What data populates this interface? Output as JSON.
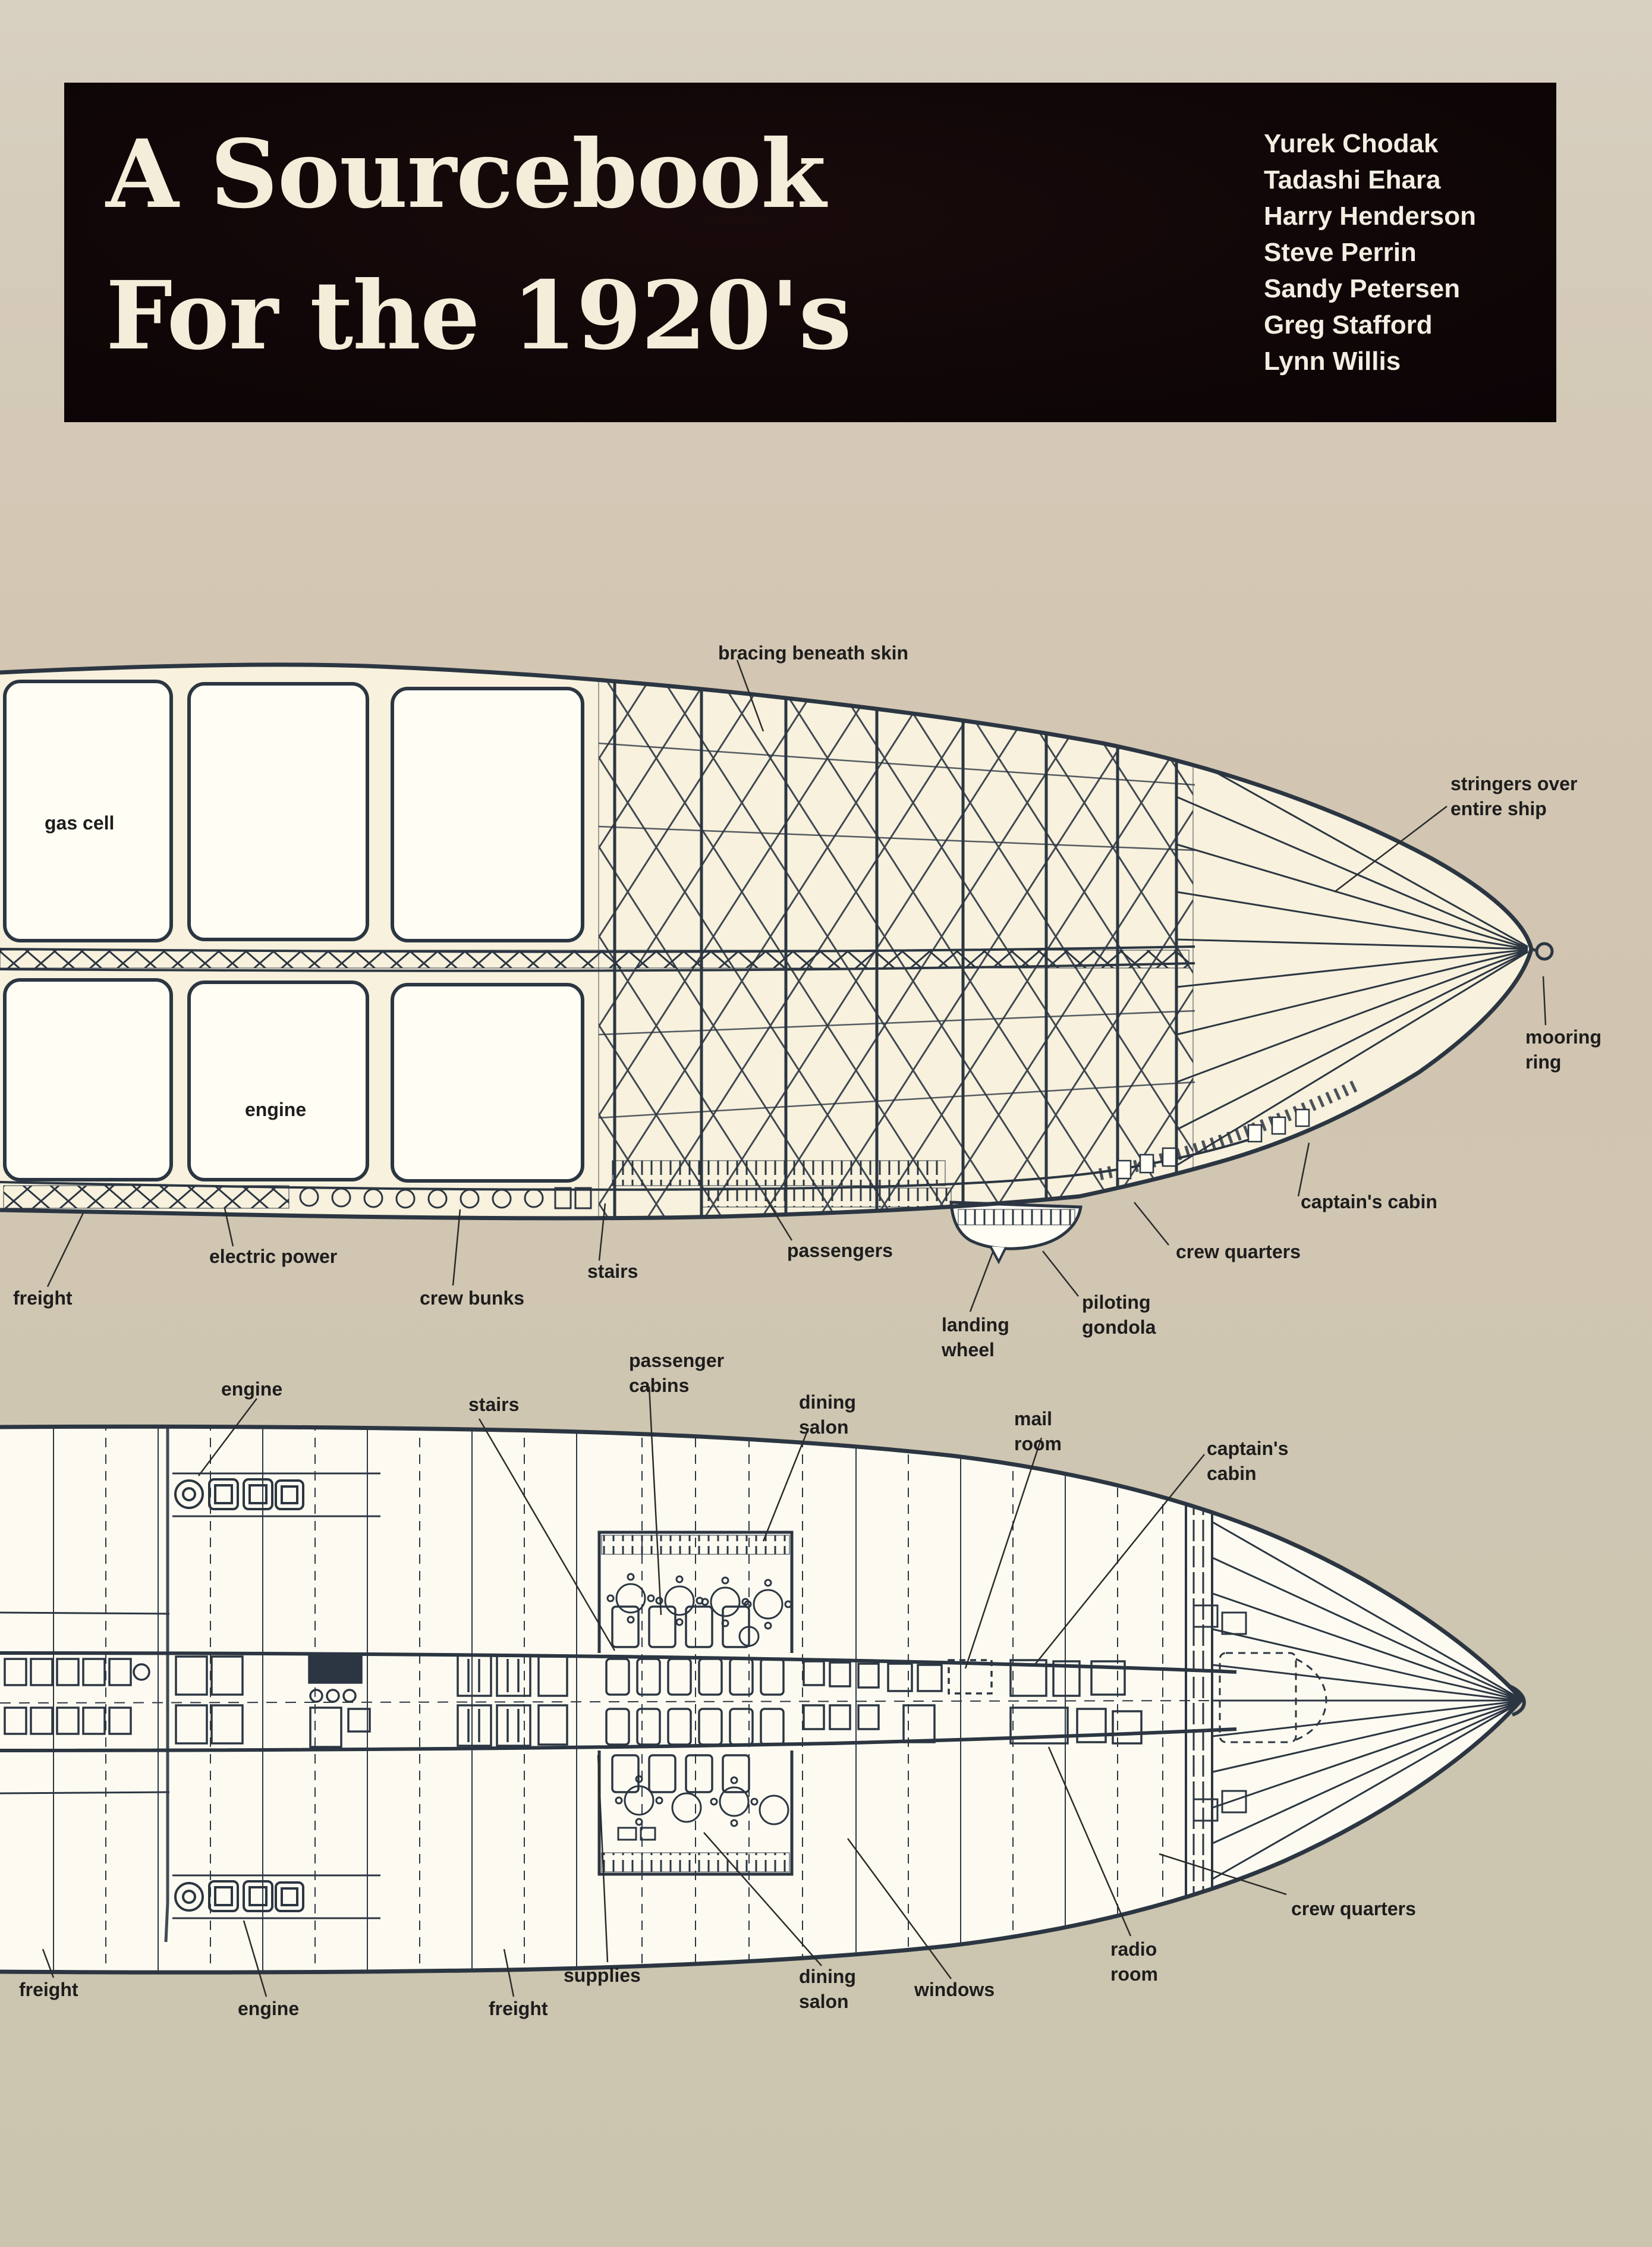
{
  "title_block": {
    "line1": "A Sourcebook",
    "line2": "For the 1920's",
    "authors": [
      "Yurek Chodak",
      "Tadashi Ehara",
      "Harry Henderson",
      "Steve Perrin",
      "Sandy Petersen",
      "Greg Stafford",
      "Lynn Willis"
    ],
    "bg_color": "#100607",
    "text_color": "#f3edd9"
  },
  "side_view": {
    "description": "airship side cutaway diagram",
    "labels": {
      "bracing_beneath_skin": "bracing beneath skin",
      "gas_cell": "gas cell",
      "stringers": "stringers over\nentire ship",
      "mooring_ring": "mooring\nring",
      "engine": "engine",
      "captains_cabin": "captain's cabin",
      "crew_quarters": "crew quarters",
      "electric_power": "electric power",
      "freight": "freight",
      "crew_bunks": "crew bunks",
      "stairs": "stairs",
      "passengers": "passengers",
      "landing_wheel": "landing\nwheel",
      "piloting_gondola": "piloting\ngondola"
    }
  },
  "plan_view": {
    "description": "airship deck plan diagram",
    "labels": {
      "engine_top": "engine",
      "stairs": "stairs",
      "passenger_cabins": "passenger\ncabins",
      "dining_salon_top": "dining\nsalon",
      "mail_room": "mail\nroom",
      "captains_cabin": "captain's\ncabin",
      "crew_quarters": "crew quarters",
      "radio_room": "radio\nroom",
      "windows": "windows",
      "dining_salon_bottom": "dining\nsalon",
      "supplies": "supplies",
      "freight_left": "freight",
      "engine_bottom": "engine",
      "freight_mid": "freight"
    }
  },
  "colors": {
    "paper_beige": "#d2c5b2",
    "ink": "#2c3642",
    "hull_cream": "#f7f1dd",
    "cell_white": "#fffdf4",
    "label_ink": "#1d1d1d"
  }
}
